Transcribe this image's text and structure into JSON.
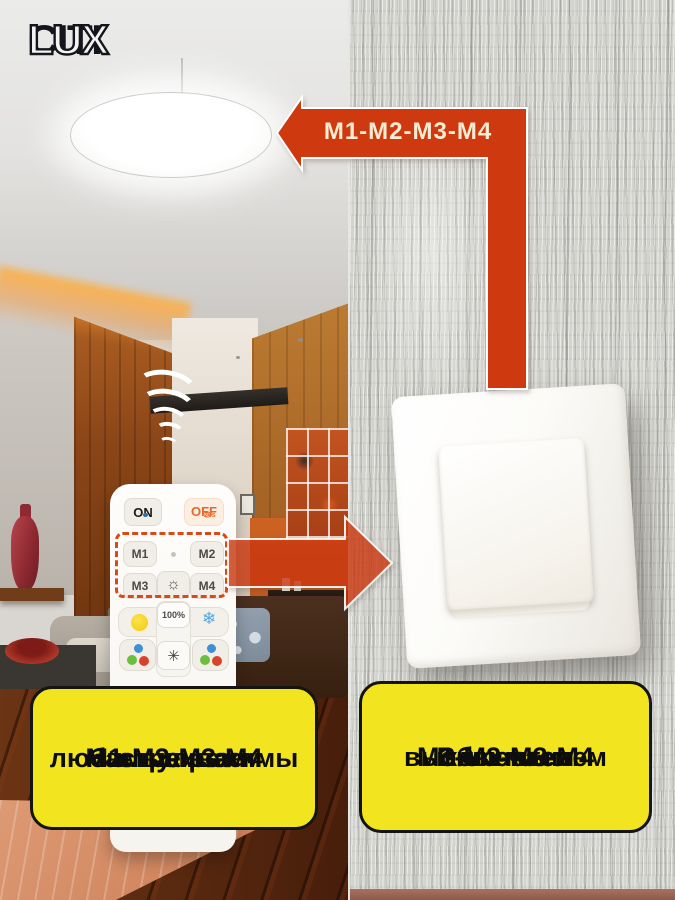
{
  "brand": {
    "logo_citi": "CITI",
    "logo_lux": "LUX"
  },
  "top_arrow": {
    "label": "М1-М2-М3-М4",
    "color": "#cf3910",
    "text_color": "#f8ecd2"
  },
  "remote": {
    "on_label": "ON",
    "off_label": "OFF",
    "off_timer": "20s",
    "m1": "M1",
    "m2": "M2",
    "m3": "M3",
    "m4": "M4",
    "brightness": "100%"
  },
  "icons": {
    "sun_glyph": "☼",
    "snowflake_glyph": "❄",
    "starburst_glyph": "✳",
    "clock_glyph": "◷"
  },
  "left_note": {
    "lines": [
      "Настраиваем",
      "любимые режимы",
      "М1-М2-М3-М4",
      "с пульта"
    ]
  },
  "right_note": {
    "lines": [
      "Включаем",
      "М1-М2-М3-М4",
      "обычным",
      "выключателем"
    ]
  },
  "colors": {
    "arrow_red": "#cf3910",
    "note_yellow": "#f2e41f",
    "dashed_red": "#d84a18",
    "off_orange": "#e8672a",
    "wall_gray": "#d4d4cf"
  }
}
